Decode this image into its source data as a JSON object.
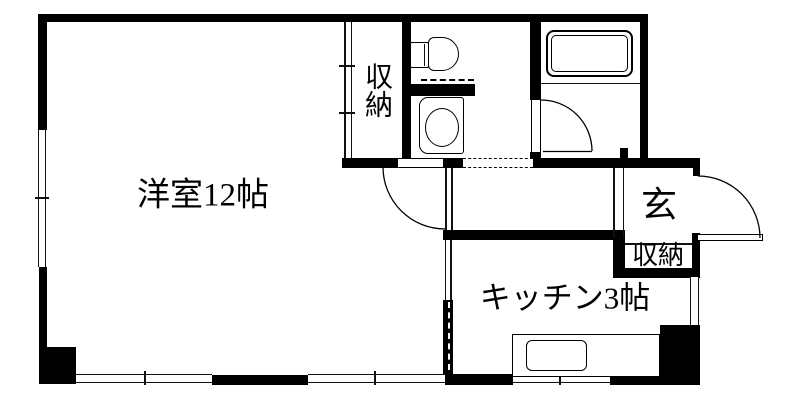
{
  "plan": {
    "rooms": {
      "main_room": "洋室12帖",
      "closet_main": "収納",
      "kitchen": "キッチン3帖",
      "entrance": "玄",
      "closet_entrance": "収納"
    },
    "fixtures": {
      "toilet": "toilet-icon",
      "washbasin": "washbasin-icon",
      "bathtub": "bathtub-icon",
      "kitchen_sink": "kitchen-sink-icon"
    },
    "colors": {
      "wall": "#000000",
      "line": "#111111",
      "background": "#ffffff"
    }
  }
}
